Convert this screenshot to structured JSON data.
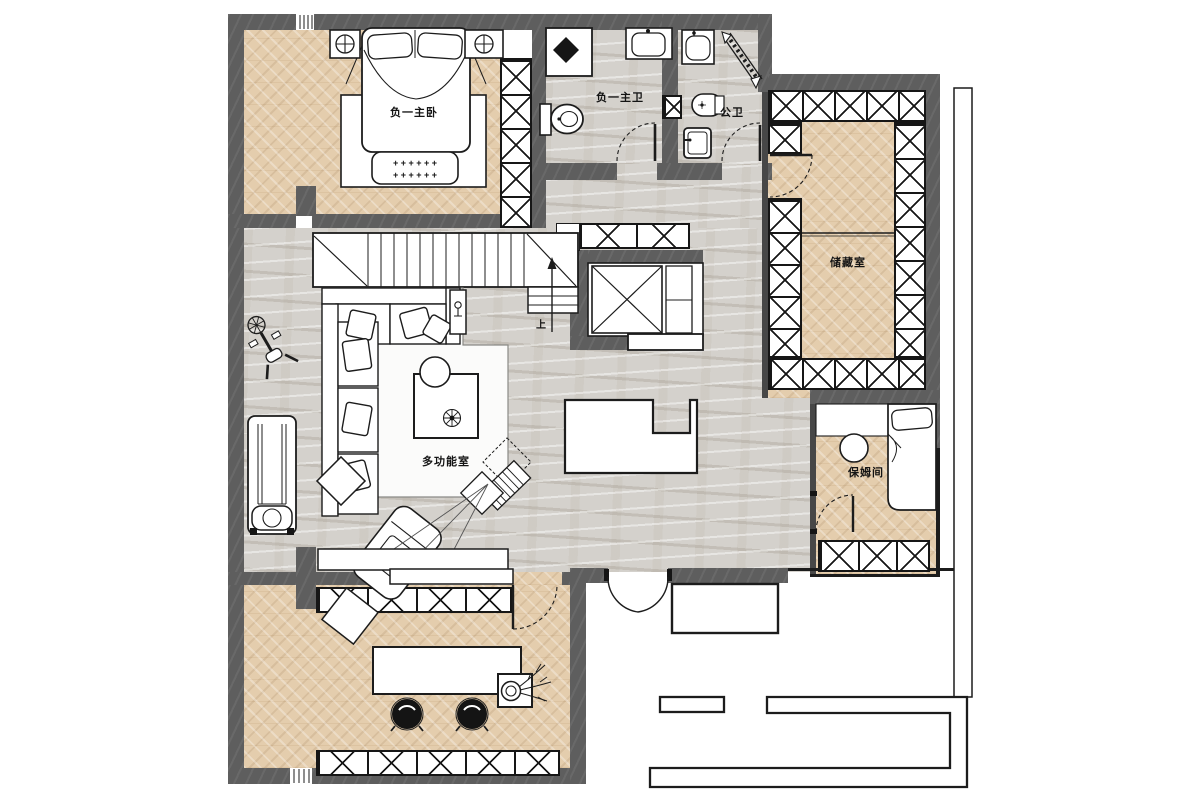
{
  "rooms": {
    "master_bedroom": "负一主卧",
    "master_bath": "负一主卫",
    "public_bath": "公卫",
    "storage": "储藏室",
    "multifunction": "多功能室",
    "nanny": "保姆间"
  },
  "stairs": {
    "up": "上"
  },
  "decor": {
    "rug_row": "+ + +   + + +"
  },
  "colors": {
    "wall": "#5e5e5e",
    "wood": "#e4cdad",
    "marble": "#d4d1cc",
    "outline": "#1c1c1c"
  }
}
